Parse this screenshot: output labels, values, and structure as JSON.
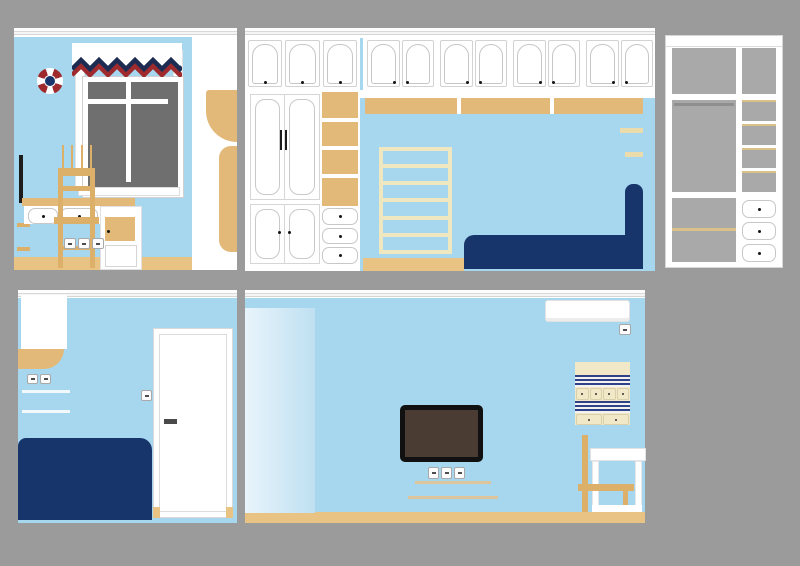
{
  "document_type": "interior-elevation-drawing-set",
  "room_theme": "children-room-nautical-blue",
  "palette": {
    "bg": "#9b9b9b",
    "wall": "#a6d7ee",
    "white": "#ffffff",
    "tan": "#e3b97a",
    "tanDeep": "#ddb06a",
    "floor": "#e8c383",
    "cream": "#f0e8c6",
    "creamLadder": "#efe7c0",
    "creamShelf": "#ecdcab",
    "navy": "#17356b",
    "navyDeep": "#122c5c",
    "valNavy": "#1d2b52",
    "valRed": "#9e2a2e",
    "glass": "#6f6f6f",
    "grayInt": "#a9a9a9",
    "tanShelf": "#d9c188",
    "tvFrame": "#111111",
    "tvScreen": "#4a3b33",
    "stripe": "#2e4288",
    "wood": "#ddb06a",
    "sheer1": "#e8f4fb",
    "sheer2": "#bfe0f1",
    "handleGray": "#4a4a4a"
  },
  "panels": [
    {
      "id": "window-wall",
      "position": "top-left"
    },
    {
      "id": "bed-cabinet-wall",
      "position": "top-middle"
    },
    {
      "id": "wardrobe-interior",
      "position": "top-right"
    },
    {
      "id": "door-wall",
      "position": "bottom-left"
    },
    {
      "id": "tv-wall",
      "position": "bottom-right"
    }
  ],
  "counts": {
    "p1_desk_switch_plates": 3,
    "p1_chair_back_slats": 4,
    "p2_left_upper_doors": 3,
    "p2_right_upper_door_pairs": 4,
    "p2_wardrobe_drawers": 3,
    "p2_ladder_rungs": 7,
    "p3_side_shelf_cells": 4,
    "p3_drawers": 3,
    "p5_organizer_top_pockets": 4,
    "p5_organizer_bottom_pockets": 2,
    "p5_tv_outlets": 3
  }
}
